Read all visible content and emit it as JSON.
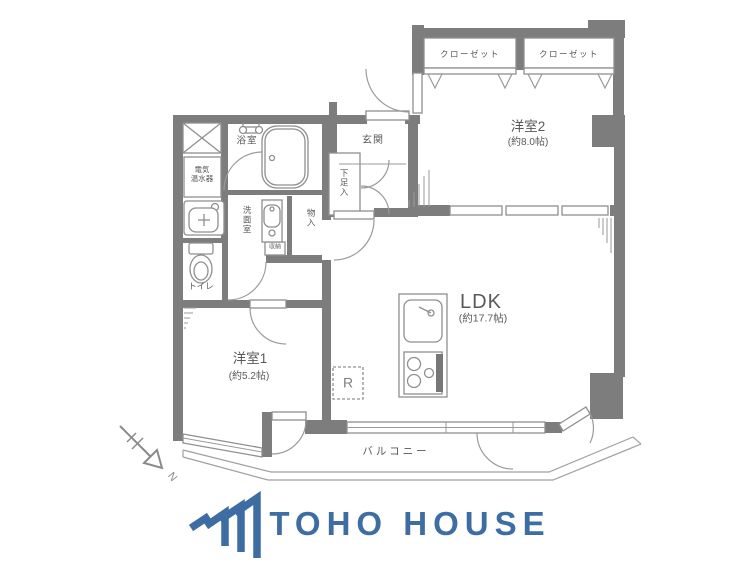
{
  "plan": {
    "closet1": "クローゼット",
    "closet2": "クローゼット",
    "room2_name": "洋室2",
    "room2_size": "(約8.0帖)",
    "entrance": "玄関",
    "shoe_cabinet": "下足入",
    "bathroom": "浴室",
    "water_heater": "電気\n温水器",
    "washroom": "洗面室",
    "storage": "物入",
    "small_storage": "収納",
    "toilet": "トイレ",
    "room1_name": "洋室1",
    "room1_size": "(約5.2帖)",
    "ldk_name": "LDK",
    "ldk_size": "(約17.7帖)",
    "balcony": "バルコニー",
    "refrigerator_label": "R",
    "compass_north": "N"
  },
  "footer": {
    "brand": "TOHO HOUSE"
  },
  "colors": {
    "wall_gray": "#7d7d7d",
    "line_gray": "#9a9a9a",
    "text_gray": "#595959",
    "brand_blue": "#3e6da4"
  }
}
